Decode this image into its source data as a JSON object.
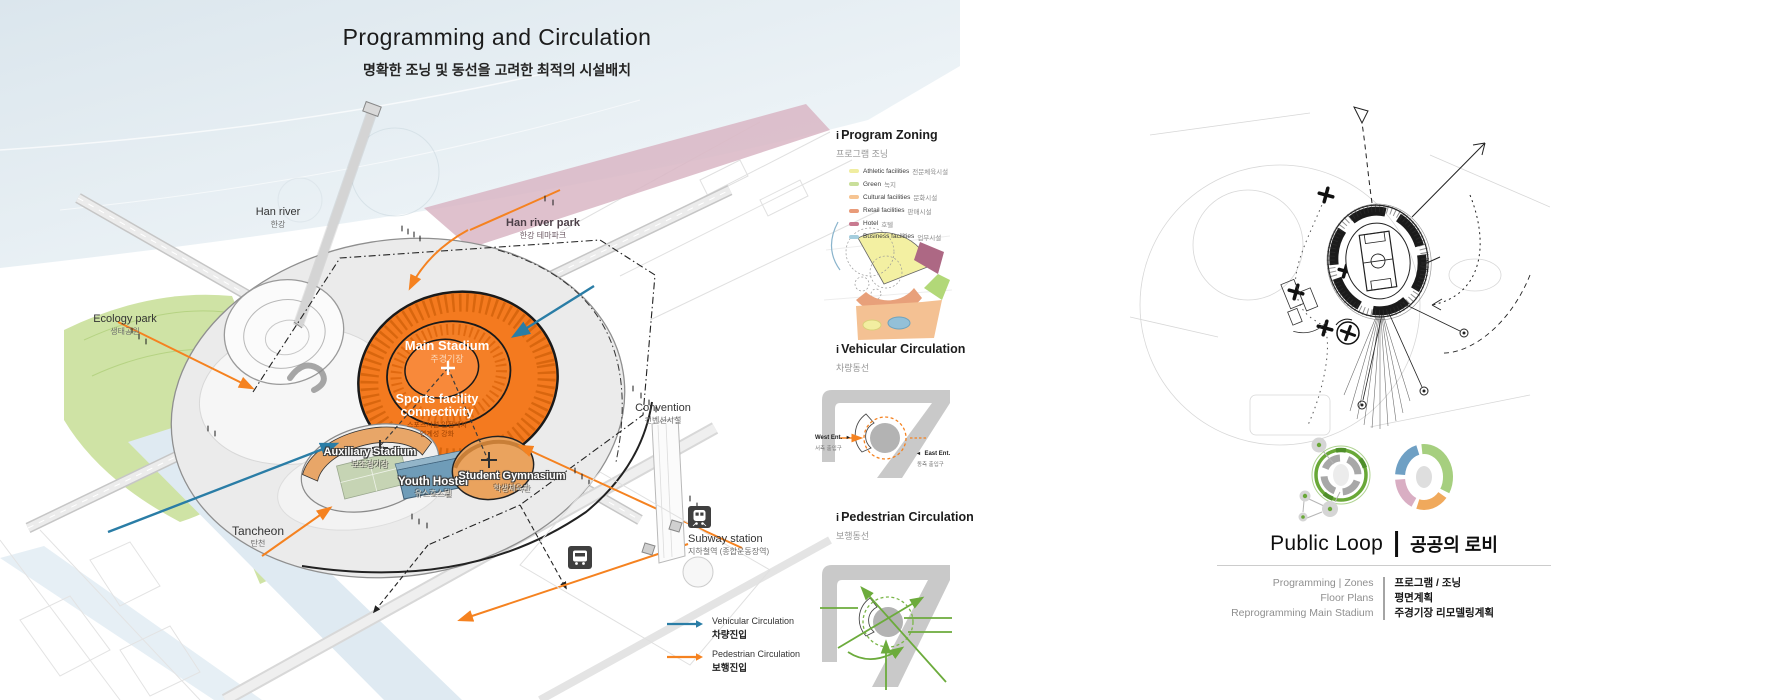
{
  "header": {
    "title": "Programming and Circulation",
    "subtitle": "명확한 조닝 및 동선을 고려한 최적의 시설배치"
  },
  "site_labels": {
    "han_river": {
      "en": "Han river",
      "ko": "한강"
    },
    "han_river_park": {
      "en": "Han river park",
      "ko": "한강 테마파크"
    },
    "ecology_park": {
      "en": "Ecology park",
      "ko": "생태공원"
    },
    "tancheon": {
      "en": "Tancheon",
      "ko": "탄천"
    },
    "convention": {
      "en": "Convention",
      "ko": "컨벤션시설"
    },
    "subway": {
      "en": "Subway station",
      "ko": "지하철역 (종합운동장역)"
    }
  },
  "facilities": {
    "main_stadium": {
      "en": "Main Stadium",
      "ko": "주경기장"
    },
    "connectivity": {
      "en1": "Sports facility",
      "en2": "connectivity",
      "ko1": "스포츠시설 인접배치",
      "ko2": "연계성 강화"
    },
    "auxiliary_stadium": {
      "en": "Auxiliary Stadium",
      "ko": "보조경기장"
    },
    "youth_hostel": {
      "en": "Youth Hostel",
      "ko": "유스호스텔"
    },
    "student_gymnasium": {
      "en": "Student Gymnasium",
      "ko": "학생체육관"
    }
  },
  "map_legend": {
    "vehicular": {
      "en": "Vehicular Circulation",
      "ko": "차량진입",
      "color": "#2a7da6"
    },
    "pedestrian": {
      "en": "Pedestrian Circulation",
      "ko": "보행진입",
      "color": "#f58220"
    }
  },
  "sidebar": {
    "zoning": {
      "marker": "i",
      "title": "Program Zoning",
      "ko": "프로그램 조닝",
      "items": [
        {
          "label": "Athletic facilities",
          "ko": "전문체육시설",
          "color": "#f0eda0"
        },
        {
          "label": "Green",
          "ko": "녹지",
          "color": "#c9df9a"
        },
        {
          "label": "Cultural facilities",
          "ko": "문화시설",
          "color": "#f6c492"
        },
        {
          "label": "Retail facilities",
          "ko": "판매시설",
          "color": "#e99b79"
        },
        {
          "label": "Hotel",
          "ko": "호텔",
          "color": "#c87a90"
        },
        {
          "label": "Business facilities",
          "ko": "업무시설",
          "color": "#a5cede"
        }
      ]
    },
    "vehicular": {
      "marker": "i",
      "title": "Vehicular Circulation",
      "ko": "차량동선",
      "west": {
        "en": "West Ent.",
        "ko": "서측 출입구",
        "mark": "▸"
      },
      "east": {
        "en": "East Ent.",
        "ko": "동측 출입구",
        "mark": "◂"
      }
    },
    "pedestrian": {
      "marker": "i",
      "title": "Pedestrian Circulation",
      "ko": "보행동선"
    }
  },
  "right_panel": {
    "public_loop": {
      "en": "Public Loop",
      "ko": "공공의 로비"
    },
    "programs": [
      {
        "en": "Programming | Zones",
        "ko": "프로그램 / 조닝"
      },
      {
        "en": "Floor Plans",
        "ko": "평면계획"
      },
      {
        "en": "Reprogramming Main Stadium",
        "ko": "주경기장 리모델링계획"
      }
    ]
  }
}
